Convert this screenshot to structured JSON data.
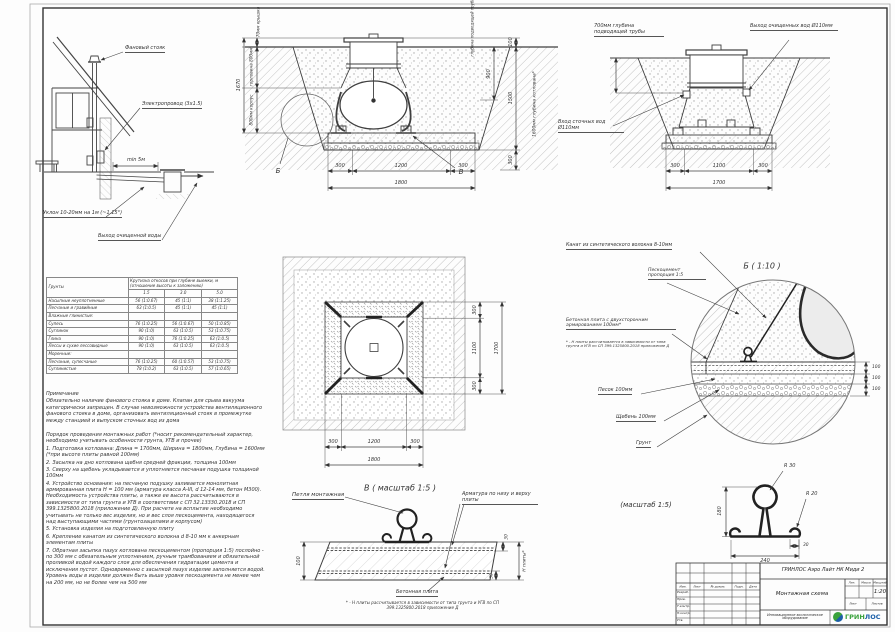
{
  "house": {
    "vent_stack": "Фановый стояк",
    "electric": "Электропровод (3х1.5)",
    "min_dist": "min 5м",
    "slope": "Уклон 10-20мм на 1м (~1.15°)",
    "outlet": "Выход очищенной воды"
  },
  "section_main": {
    "total_height": "1670",
    "lid": "70мм крышка",
    "neck": "горловина 800мм",
    "body": "800мм корпус",
    "pipe_depth": "глубина подводящей трубы",
    "d100": "100",
    "d900": "900",
    "d1500": "1500",
    "d300": "300",
    "pit_depth": "1600мм глубина котлована*",
    "b300l": "300",
    "b1200": "1200",
    "b300r": "300",
    "b1800": "1800",
    "letter_b": "Б",
    "letter_v": "В"
  },
  "section_side": {
    "pipe_depth": "700мм глубина подводящей трубы",
    "outlet": "Выход очищенных вод Ø110мм",
    "inlet": "Вход сточных вод Ø110мм",
    "b300l": "300",
    "b1100": "1100",
    "b300r": "300",
    "b1700": "1700"
  },
  "plan": {
    "r300t": "300",
    "r1100": "1100",
    "r300b": "300",
    "r1700": "1700",
    "b300l": "300",
    "b1200": "1200",
    "b300r": "300",
    "b1800": "1800"
  },
  "soil_table": {
    "col_soil": "Грунты",
    "col_main": "Крутизна откосов при глубине выемки, м (отношение высоты к заложению)",
    "depths": [
      "1.5",
      "3.0",
      "5.0"
    ],
    "rows": [
      {
        "name": "Насыпные неуплотненные",
        "v": [
          "56 (1:0.67)",
          "45 (1:1)",
          "38 (1:1.25)"
        ]
      },
      {
        "name": "Песчаные и гравийные",
        "v": [
          "63 (1:0.5)",
          "45 (1:1)",
          "45 (1:1)"
        ]
      },
      {
        "name": "Влажные глинистые:",
        "v": [
          "",
          "",
          ""
        ]
      },
      {
        "name": "Супесь",
        "v": [
          "76 (1:0.25)",
          "56 (1:0.67)",
          "50 (1:0.85)"
        ]
      },
      {
        "name": "Суглинок",
        "v": [
          "90 (1:0)",
          "63 (1:0.5)",
          "53 (1:0.75)"
        ]
      },
      {
        "name": "Глина",
        "v": [
          "90 (1:0)",
          "76 (1:0.25)",
          "63 (1:0.5)"
        ]
      },
      {
        "name": "Лессы и сухие лессовидные",
        "v": [
          "90 (1:0)",
          "63 (1:0.5)",
          "63 (1:0.5)"
        ]
      },
      {
        "name": "Моренные:",
        "v": [
          "",
          "",
          ""
        ]
      },
      {
        "name": "Песчаные, супесчаные",
        "v": [
          "76 (1:0.25)",
          "60 (1:0.57)",
          "53 (1:0.75)"
        ]
      },
      {
        "name": "Суглинистые",
        "v": [
          "78 (1:0.2)",
          "63 (1:0.5)",
          "57 (1:0.65)"
        ]
      }
    ]
  },
  "notes": {
    "title": "Примечание",
    "p1": "Обязательно наличие фанового стояка в доме. Клапан для срыва вакуума категорически запрещен. В случае невозможности устройства вентиляционного фанового стояка в доме, организовать вентиляционный стояк в промежутке между станцией и выпуском сточных вод из дома",
    "order_title": "Порядок проведения монтажных работ (*носит рекомендательный характер, необходимо учитывать особенности грунта, УГВ и прочее)",
    "items": [
      "1. Подготовка котлована: Длина = 1700мм,  Ширина = 1800мм, Глубина = 1600мм (*при высоте плиты равной 100мм)",
      "2. Засыпка на дно котлована щебня средней фракции, толщина 100мм",
      "3. Сверху на щебень укладывается и уплотняется песчаная подушка толщиной 100мм",
      "4. Устройство основания: на песчаную подушку заливается монолитная армированная плита Н = 100 мм (арматура класса А-III, d 12-14 мм, бетон М300). Необходимость устройства плиты, а также ее высота рассчитываются в зависимости от типа грунта и УГВ в соответствии с СП 32.13330.2018 и СП 399.1325800.2018 (приложение Д). При расчете на всплытие необходимо учитывать не только вес изделия, но и вес слоя пескоцемента, находящегося над выступающими частями (грунтозацепами и корпусом)",
      "5. Установка изделия на подготовленную плиту",
      "6. Крепление канатом из синтетического волокна d 8-10 мм к анкерным элементам плиты",
      "7. Обратная засыпка пазух котлована пескоцементом (пропорция 1:5) послойно - по 300 мм с обязательным уплотнением, ручным трамбованием и обязательной проливкой водой каждого слоя для обеспечения гидратации цемента и исключения пустот. Одновременно с засыпкой пазух изделие заполняется водой. Уровень воды в изделии должен быть выше уровня пескоцемента не менее чем на 200 мм, но не более чем на 500 мм"
    ]
  },
  "detail_v": {
    "caption": "В ( масштаб 1:5 )",
    "loop": "Петля монтажная",
    "rebar": "Арматура по низу и верху плиты",
    "slab": "Бетонная плита",
    "footnote": "* - Н плиты рассчитывается в зависимости от типа грунта и УГВ по СП 399.1325800.2018 приложение Д",
    "d100": "100",
    "d30t": "30",
    "d30b": "30",
    "dh": "Н плиты*"
  },
  "detail_b": {
    "caption": "Б ( 1:10 )",
    "rope": "Канат из синтетического волокна 8-10мм",
    "pesco": "Пескоцемент пропорция 1:5",
    "slab": "Бетонная плита с двухсторонним армированием 100мм*",
    "footnote": "* - Н плиты рассчитывается в зависимости от типа грунта и УГВ по СП 399.1325800.2018 приложение Д",
    "sand": "Песок 100мм",
    "gravel": "Щебень 100мм",
    "soil": "Грунт",
    "d1": "100",
    "d2": "100",
    "d3": "100"
  },
  "loop_detail": {
    "caption": "(масштаб 1:5)",
    "r30": "R 30",
    "r20": "R 20",
    "d180": "180",
    "d30": "30",
    "d240": "240"
  },
  "title_block": {
    "product": "ГРИНЛОС Аэро Лайт НК Миди 2",
    "doc_title": "Монтажная схема",
    "scale": "1:20",
    "header_cells": [
      "Изм.",
      "Лист",
      "№ докум.",
      "Подп.",
      "Дата"
    ],
    "rows": [
      "Разраб.",
      "Пров.",
      "Т.контр.",
      "Н.контр.",
      "Утв."
    ],
    "lit": "Лит.",
    "mass": "Масса",
    "scale_label": "Масштаб",
    "sheet_label": "Лист",
    "sheets_label": "Листов",
    "slogan": "Инновационное экологическое оборудование",
    "logo_green": "ГРИН",
    "logo_blue": "ЛОС"
  },
  "colors": {
    "logo_green": "#3aa23c",
    "logo_blue": "#1b5fa8",
    "line": "#3c3c3c"
  }
}
